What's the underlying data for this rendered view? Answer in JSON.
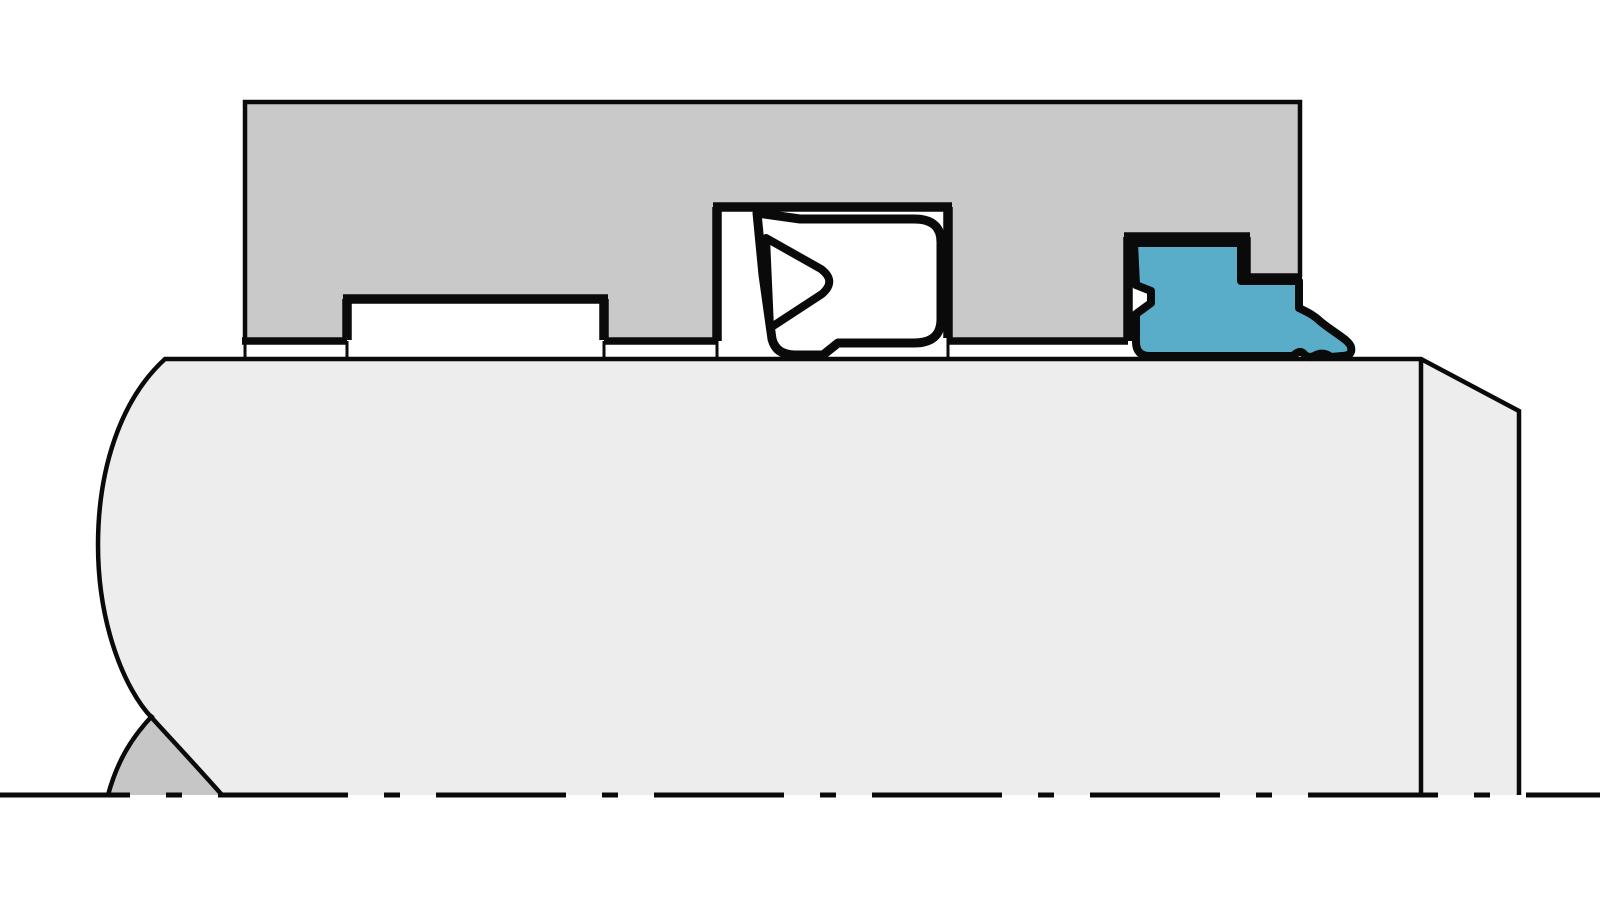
{
  "diagram": {
    "kind": "technical cross-section drawing",
    "subject": "rod sealing system: gland housing with U-cup rod seal, empty groove and wiper seal on a piston rod, drawn to an axis centerline"
  },
  "colors": {
    "background": "#ffffff",
    "outline": "#0a0a0a",
    "housing": "#c9c9c9",
    "rod": "#ededed",
    "break_lens": "#c6c6c6",
    "wiper_seal": "#5aadc8",
    "seal_body": "#ffffff",
    "seal_void": "#ffffff"
  },
  "parts": {
    "housing": "seal gland housing (section)",
    "rod": "piston rod (section)",
    "empty_groove": "empty seal groove",
    "u_cup_seal": "U-cup rod seal with V lip recess",
    "wiper_seal": "wiper / scraper seal",
    "break_symbol": "shaft break symbol",
    "centerline": "axis of symmetry (dash-dot centerline)"
  }
}
